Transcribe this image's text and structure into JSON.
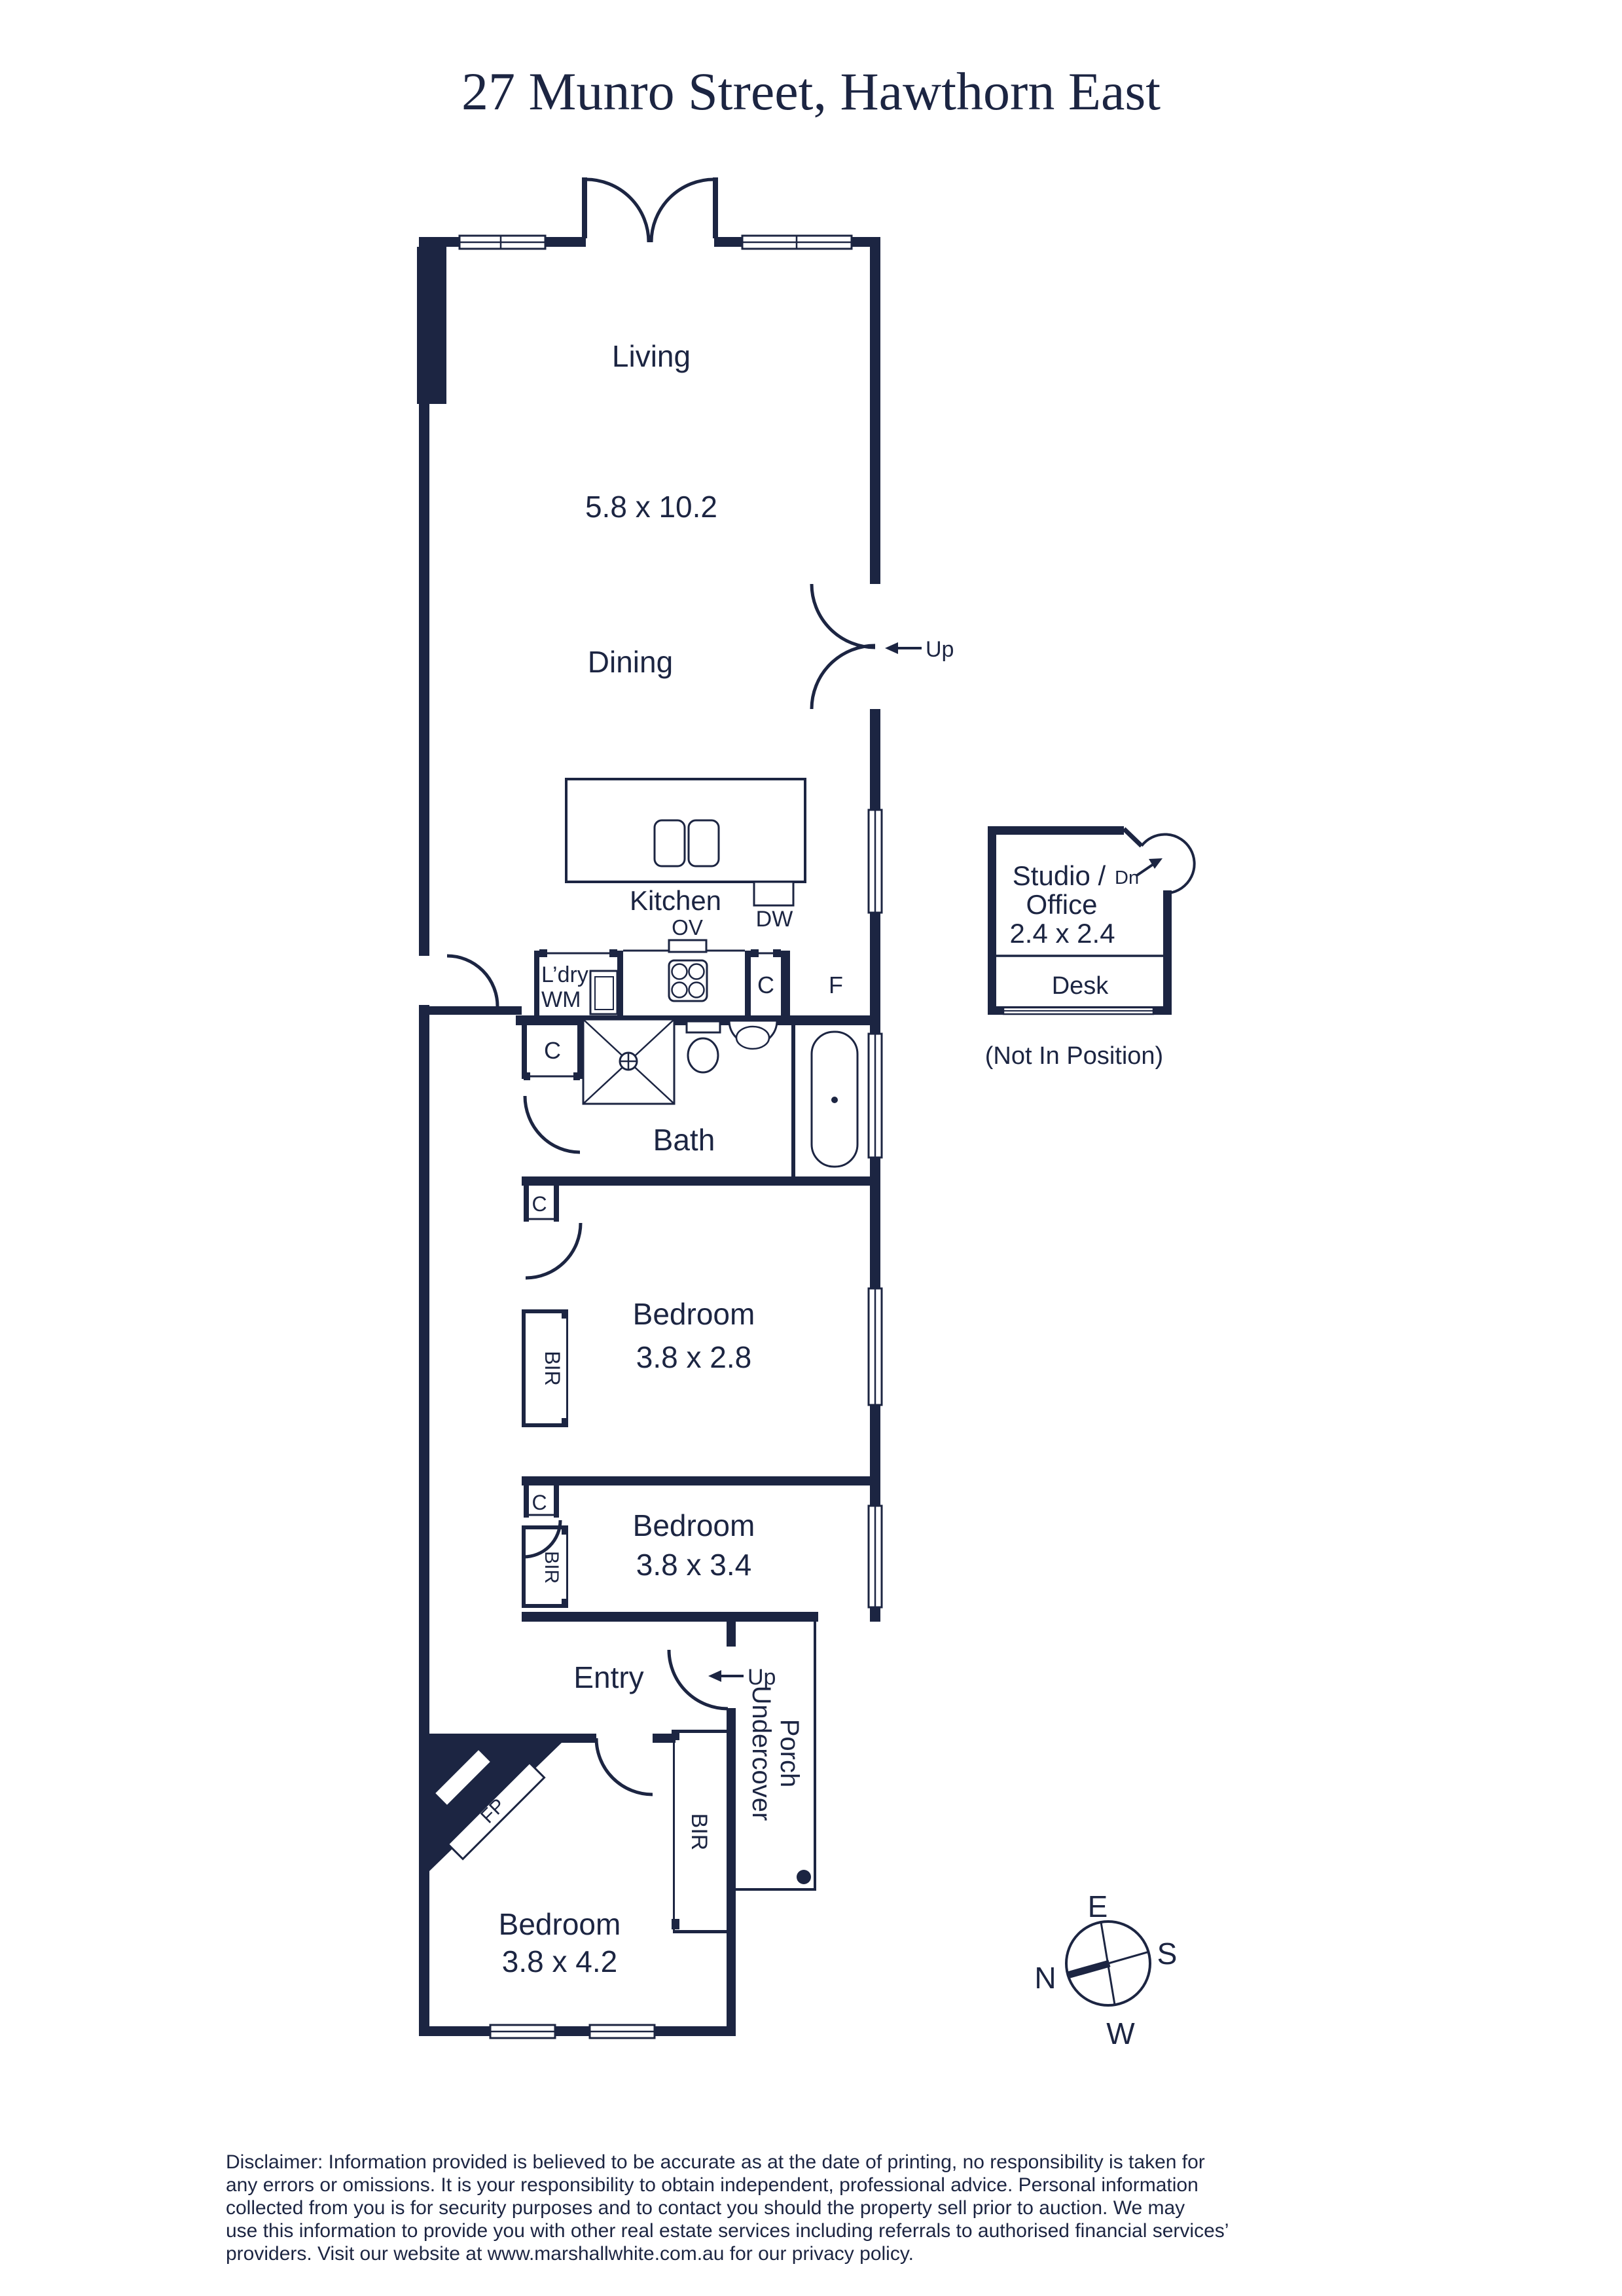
{
  "title": "27 Munro Street, Hawthorn East",
  "plan": {
    "living": {
      "label": "Living",
      "dims": "5.8 x 10.2"
    },
    "dining": {
      "label": "Dining",
      "up": "Up"
    },
    "kitchen": {
      "label": "Kitchen",
      "dishwasher": "DW",
      "oven": "OV",
      "cupboard": "C",
      "fridge": "F"
    },
    "laundry": {
      "line1": "L’dry",
      "line2": "WM"
    },
    "bath": {
      "label": "Bath",
      "cupboard": "C"
    },
    "bed1": {
      "label": "Bedroom",
      "dims": "3.8 x 2.8",
      "robe": "BIR",
      "cupboard": "C"
    },
    "bed2": {
      "label": "Bedroom",
      "dims": "3.8 x 3.4",
      "robe": "BIR",
      "cupboard": "C"
    },
    "entry": {
      "label": "Entry",
      "up": "Up"
    },
    "bed3": {
      "label": "Bedroom",
      "dims": "3.8 x 4.2",
      "robe": "BIR",
      "fireplace": "FP"
    },
    "porch": {
      "line1": "Undercover",
      "line2": "Porch"
    },
    "studio": {
      "line1": "Studio /",
      "down": "Dn",
      "line2": "Office",
      "dims": "2.4 x 2.4",
      "desk": "Desk",
      "note": "(Not In Position)"
    }
  },
  "compass": {
    "e": "E",
    "s": "S",
    "w": "W",
    "n": "N"
  },
  "disclaimer": [
    "Disclaimer: Information provided is believed to be accurate as at the date of printing, no responsibility is taken for",
    "any errors or omissions. It is your responsibility to obtain independent, professional advice. Personal information",
    "collected from you is for security purposes and to contact you should the property sell prior to auction. We may",
    "use this information to provide you with other real estate services including referrals to authorised financial services’",
    "providers. Visit our website at www.marshallwhite.com.au for our privacy policy."
  ],
  "colors": {
    "ink": "#1c2542",
    "paper": "#ffffff"
  }
}
